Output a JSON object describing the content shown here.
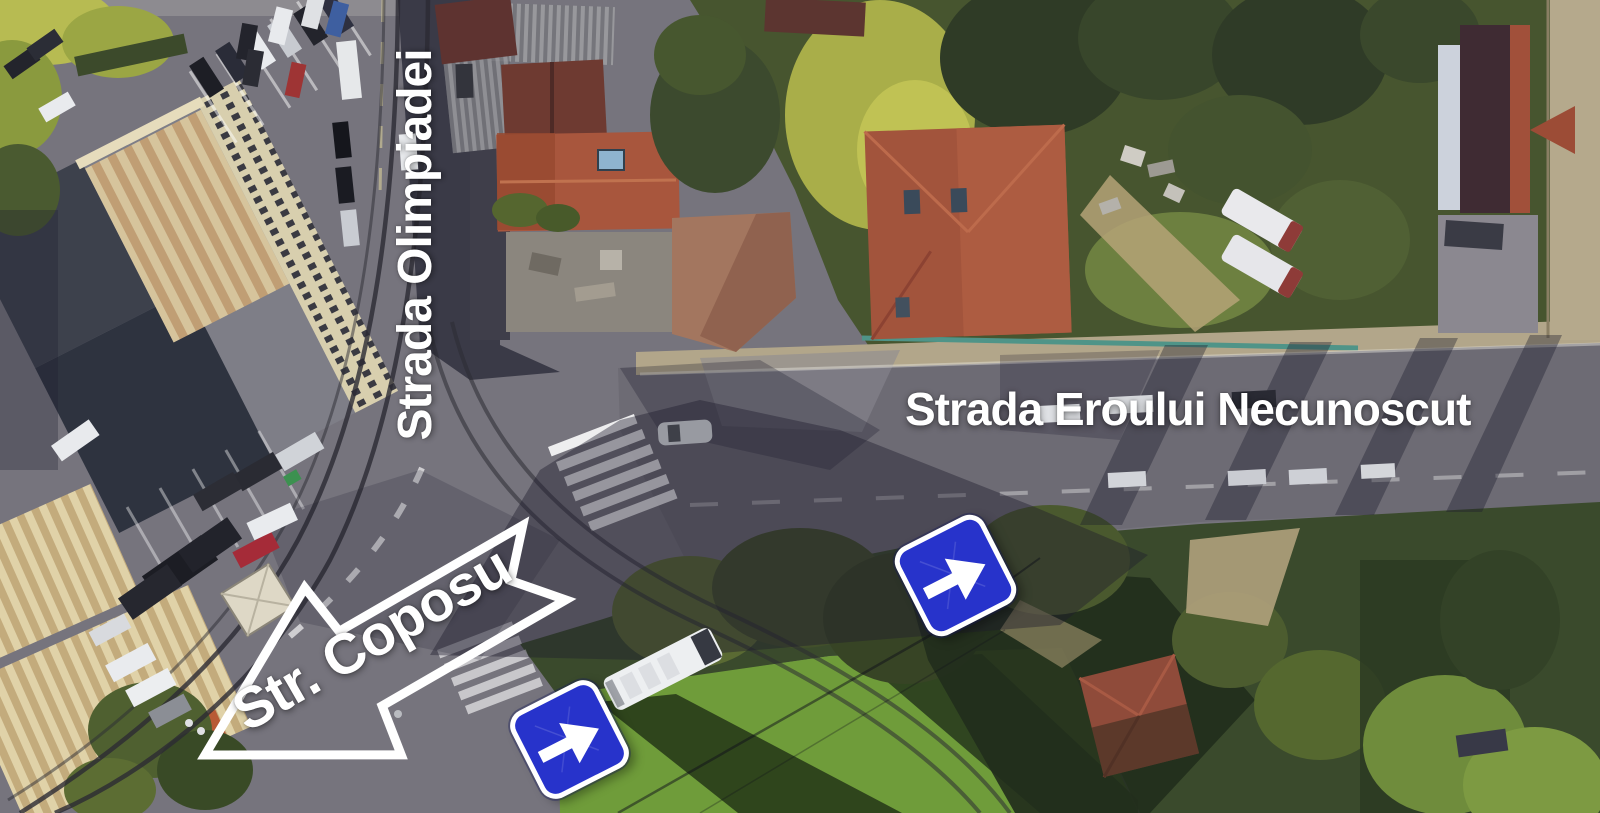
{
  "scene": {
    "description": "Aerial satellite photo of a street intersection with annotated road names",
    "road_labels": {
      "vertical": "Strada Olimpiadei",
      "horizontal": "Strada Eroului Necunoscut",
      "arrow": "Str. Coposu"
    },
    "signs": {
      "type": "one-way",
      "count": 2,
      "color": "#2733cb",
      "symbol": "white-right-arrow"
    },
    "palette": {
      "asphalt": "#76747d",
      "deep_shadow": "#2b2a38",
      "roof_red": "#a2543c",
      "tree_dark": "#33402a",
      "tree_bright": "#aab14c",
      "lawn_green": "#6f9c3a",
      "sidewalk_tan": "#b2a68a",
      "marking_white": "#ffffff",
      "annotation_white": "#ffffff",
      "sign_blue": "#2733cb"
    }
  }
}
